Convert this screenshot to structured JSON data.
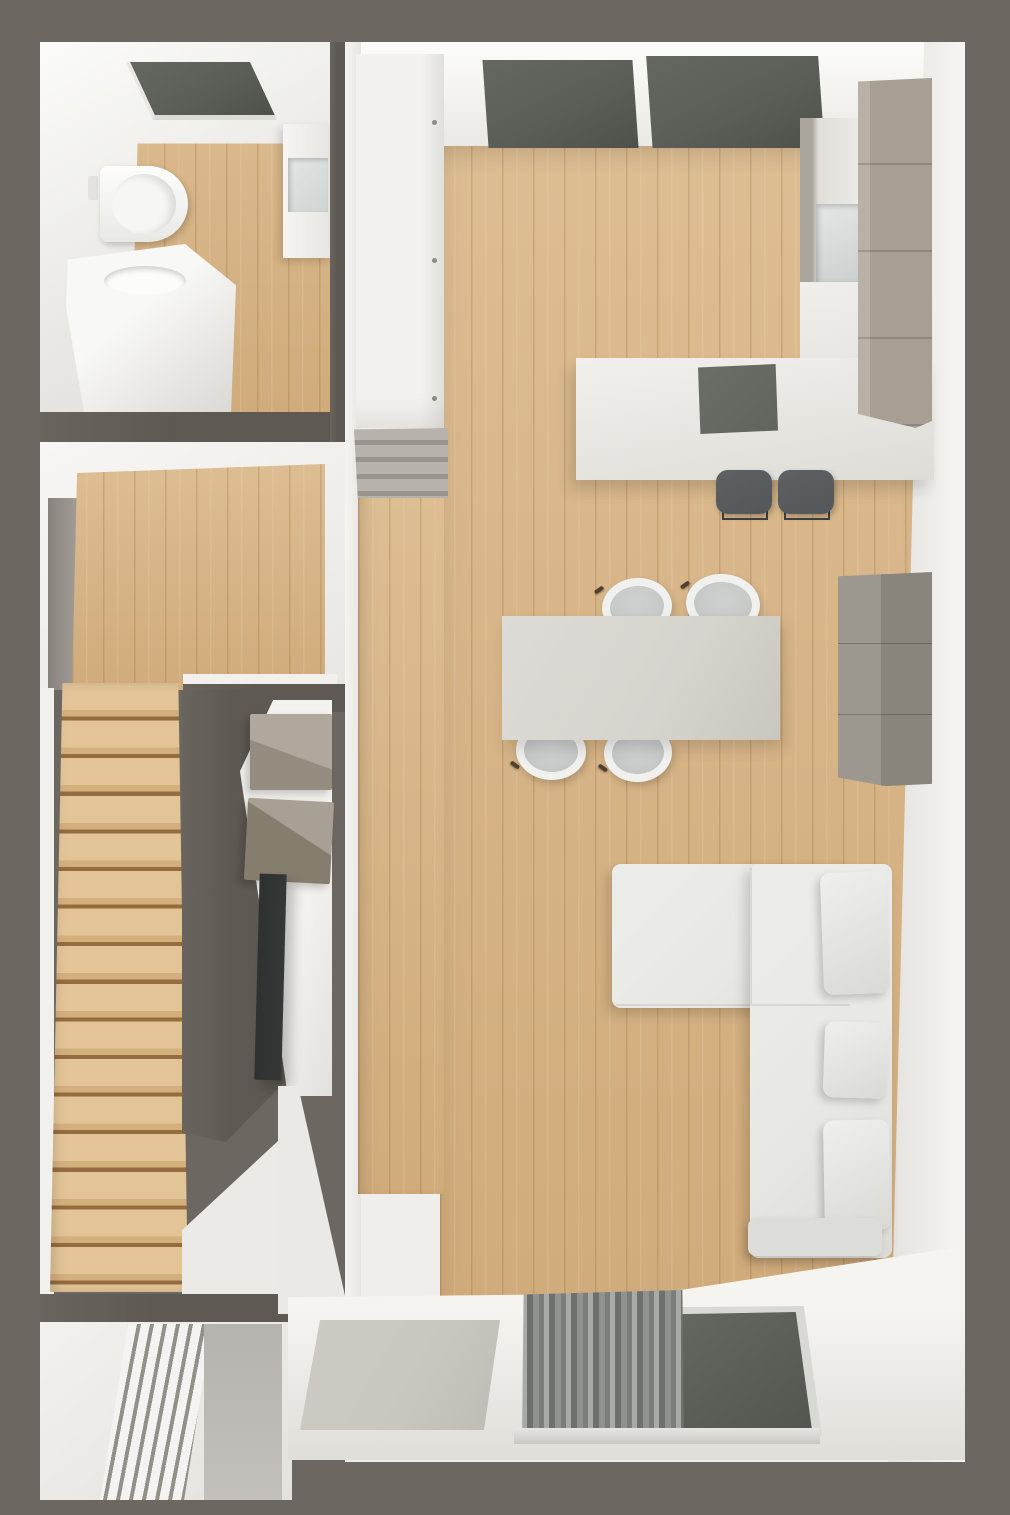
{
  "palette": {
    "bg": "#6d6761",
    "wall-dark": "#5e5952",
    "wall-white": "#f1f0ed",
    "wall-shade": "#e2e1dd",
    "wood-light": "#ddbd92",
    "wood-dark": "#d0ab7b",
    "wood-line": "rgba(120,82,38,0.20)",
    "step-light": "#e2c497",
    "step-mid": "#d4af7e",
    "step-dark": "#946c3d",
    "glass": "#5b5e57",
    "taupe": "#a79f93",
    "taupe-dark": "#8b8376",
    "counter": "#eeedea",
    "cooktop": "#61645d",
    "table": "#d6d4cd",
    "chair-seat": "#c7cac8",
    "chair-rim": "#f0f0ee",
    "stool": "#53575a",
    "sofa": "#e7e7e4",
    "pillow": "#efefed",
    "sideboard": "#94908a",
    "tv": "#353836",
    "curtain-a": "#a8aaa7",
    "curtain-b": "#6e706d",
    "mat": "#c9c6bf",
    "entry-floor": "#c3c0bb"
  },
  "floorplan": {
    "view": "top-down 3d architectural render",
    "rooms": [
      {
        "name": "bathroom",
        "items": [
          "roof-window",
          "wall-hung-toilet",
          "flush-plate",
          "washbasin-vanity",
          "shower-enclosure",
          "storage-cabinet"
        ]
      },
      {
        "name": "hallway-landing",
        "items": [
          "wood-floor",
          "wall-recess",
          "doorway-to-living-room"
        ]
      },
      {
        "name": "staircase",
        "items": [
          "wood-steps",
          "dark-partition-wall",
          "media-wall"
        ]
      },
      {
        "name": "entry-nook",
        "items": [
          "radiator-slats",
          "stone-floor"
        ]
      },
      {
        "name": "open-plan-living-kitchen",
        "items": [
          "double-window",
          "tall-white-wardrobe",
          "radiator-bench",
          "kitchen-tall-unit",
          "appliance-niche",
          "l-shaped-counter",
          "cooktop",
          "bar-stool-1",
          "bar-stool-2",
          "dining-table",
          "dining-chair-1",
          "dining-chair-2",
          "dining-chair-3",
          "dining-chair-4",
          "sideboard",
          "wall-box-1",
          "wall-box-2",
          "tv-screen",
          "corner-sofa-chaise",
          "corner-sofa-main",
          "sofa-cushion-1",
          "sofa-cushion-2",
          "sofa-cushion-3",
          "curtain",
          "glass-door",
          "doormat",
          "door-sill"
        ]
      }
    ]
  }
}
